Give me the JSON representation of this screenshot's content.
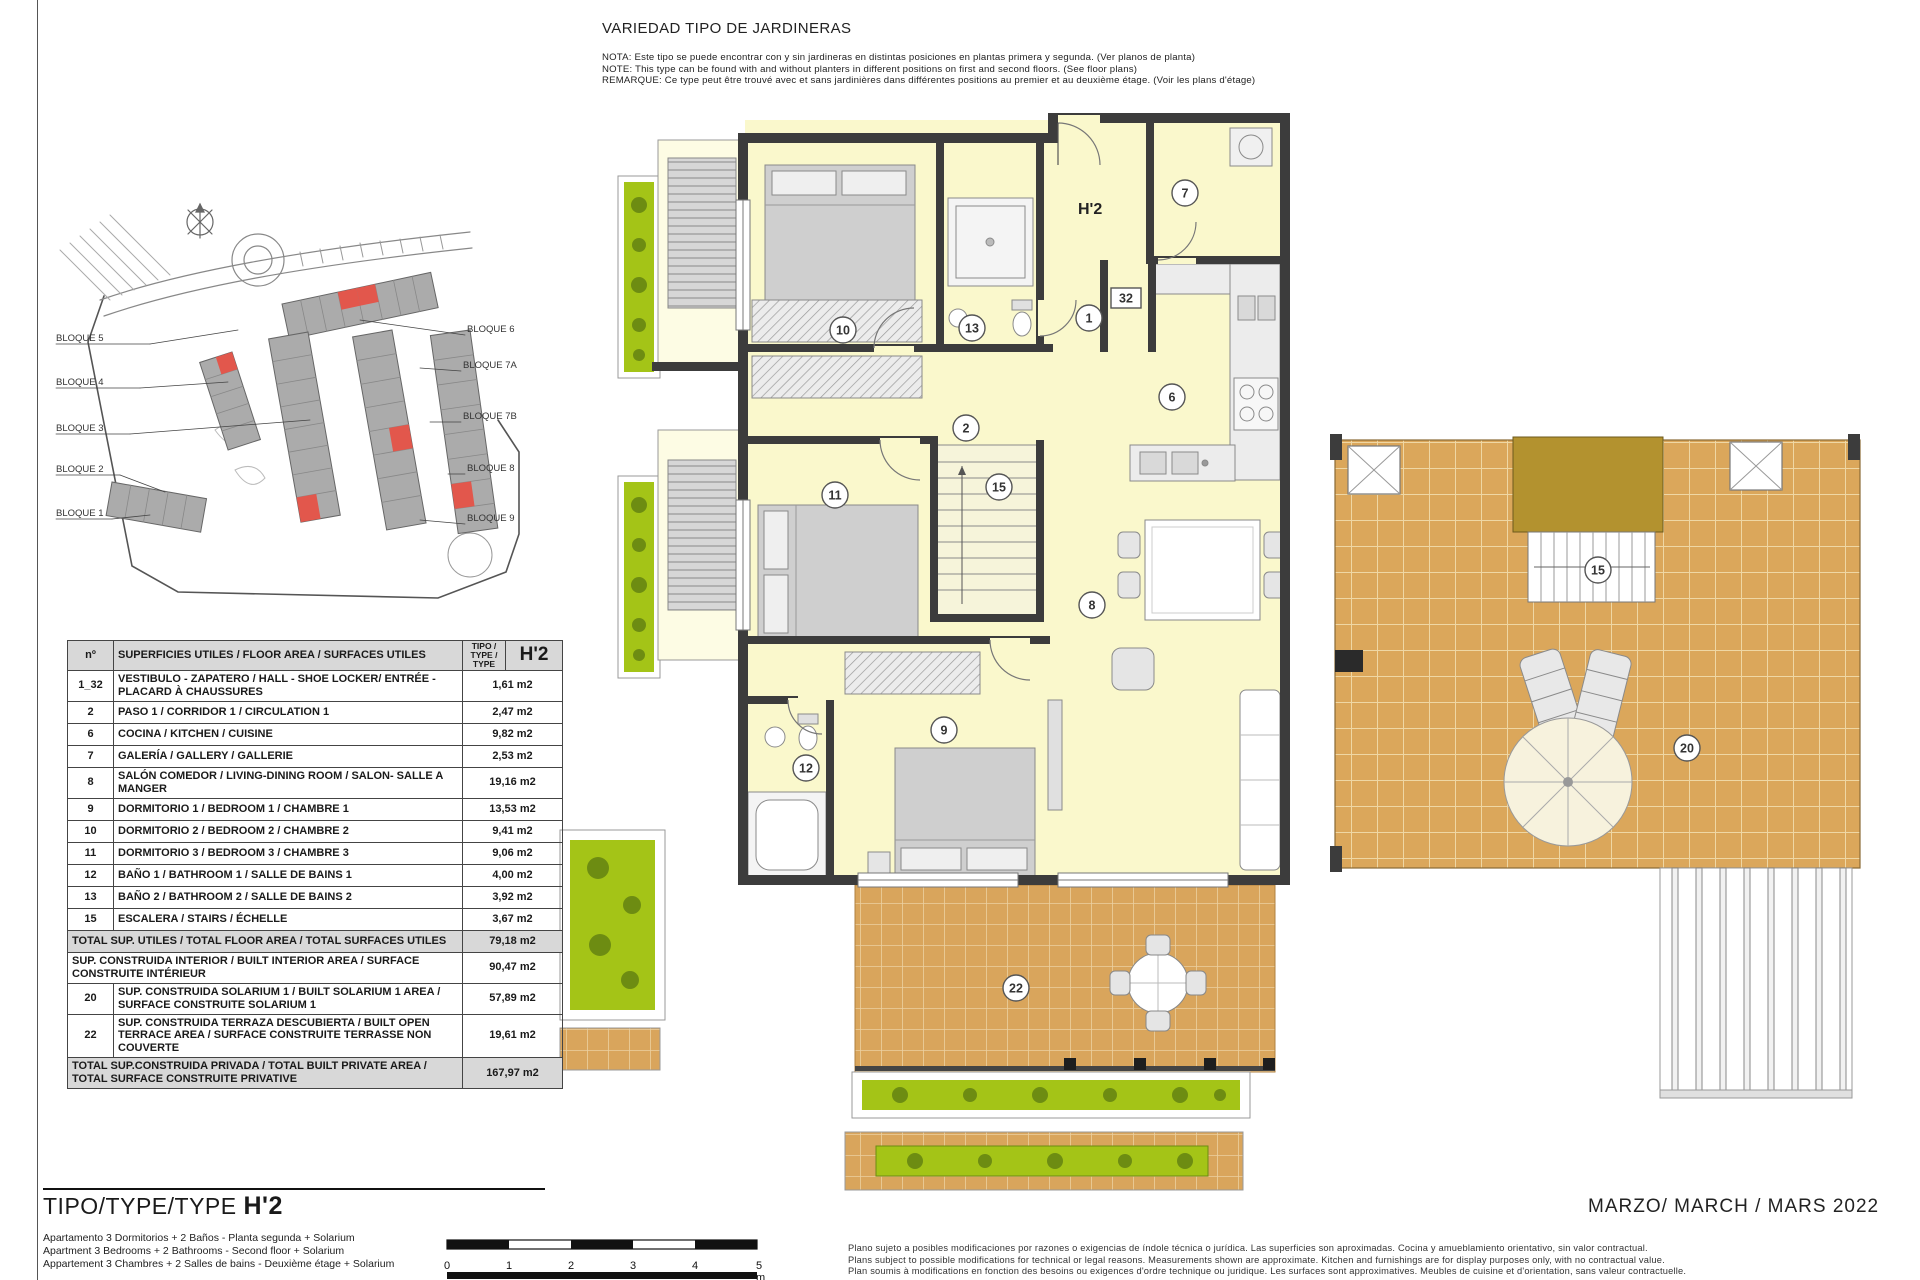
{
  "header": {
    "title": "VARIEDAD TIPO DE JARDINERAS",
    "notes": [
      "NOTA: Este tipo se puede encontrar con y sin jardineras en distintas posiciones en plantas primera y segunda. (Ver planos de planta)",
      "NOTE: This type can be found with and without planters in different positions on first and second floors. (See floor plans)",
      "REMARQUE: Ce type peut être trouvé avec et sans jardinières dans différentes positions au premier et au deuxième étage. (Voir les plans d'étage)"
    ]
  },
  "site_plan": {
    "blocks_left": [
      "BLOQUE 5",
      "BLOQUE 4",
      "BLOQUE 3",
      "BLOQUE 2",
      "BLOQUE 1"
    ],
    "blocks_right": [
      "BLOQUE 6",
      "BLOQUE 7A",
      "BLOQUE 7B",
      "BLOQUE 8",
      "BLOQUE 9"
    ]
  },
  "area_table": {
    "header": {
      "no": "nº",
      "desc": "SUPERFICIES UTILES / FLOOR AREA / SURFACES UTILES",
      "tipo": "TIPO / TYPE / TYPE",
      "type_code": "H'2"
    },
    "rows": [
      {
        "no": "1_32",
        "desc": "VESTIBULO - ZAPATERO / HALL - SHOE LOCKER/ ENTRÉE - PLACARD À CHAUSSURES",
        "value": "1,61 m2"
      },
      {
        "no": "2",
        "desc": "PASO 1 / CORRIDOR 1 / CIRCULATION 1",
        "value": "2,47 m2"
      },
      {
        "no": "6",
        "desc": "COCINA / KITCHEN / CUISINE",
        "value": "9,82 m2"
      },
      {
        "no": "7",
        "desc": "GALERÍA / GALLERY / GALLERIE",
        "value": "2,53 m2"
      },
      {
        "no": "8",
        "desc": "SALÓN COMEDOR  / LIVING-DINING ROOM / SALON- SALLE A MANGER",
        "value": "19,16 m2"
      },
      {
        "no": "9",
        "desc": "DORMITORIO 1 / BEDROOM 1 / CHAMBRE 1",
        "value": "13,53 m2"
      },
      {
        "no": "10",
        "desc": "DORMITORIO 2 / BEDROOM 2 / CHAMBRE 2",
        "value": "9,41 m2"
      },
      {
        "no": "11",
        "desc": "DORMITORIO 3 / BEDROOM 3 / CHAMBRE 3",
        "value": "9,06 m2"
      },
      {
        "no": "12",
        "desc": "BAÑO 1 / BATHROOM 1 / SALLE DE BAINS 1",
        "value": "4,00 m2"
      },
      {
        "no": "13",
        "desc": "BAÑO 2 / BATHROOM 2 / SALLE DE BAINS 2",
        "value": "3,92 m2"
      },
      {
        "no": "15",
        "desc": "ESCALERA / STAIRS / ÉCHELLE",
        "value": "3,67 m2"
      },
      {
        "no": "",
        "desc": "TOTAL SUP. UTILES / TOTAL FLOOR AREA / TOTAL SURFACES UTILES",
        "value": "79,18 m2"
      },
      {
        "no": "",
        "desc": "SUP. CONSTRUIDA INTERIOR / BUILT INTERIOR AREA / SURFACE CONSTRUITE INTÉRIEUR",
        "value": "90,47 m2"
      },
      {
        "no": "20",
        "desc": "SUP. CONSTRUIDA SOLARIUM 1 / BUILT SOLARIUM 1 AREA / SURFACE CONSTRUITE SOLARIUM 1",
        "value": "57,89 m2"
      },
      {
        "no": "22",
        "desc": "SUP. CONSTRUIDA TERRAZA DESCUBIERTA / BUILT OPEN TERRACE AREA /  SURFACE CONSTRUITE TERRASSE NON COUVERTE",
        "value": "19,61 m2"
      },
      {
        "no": "",
        "desc": "TOTAL SUP.CONSTRUIDA PRIVADA / TOTAL  BUILT PRIVATE AREA / TOTAL SURFACE CONSTRUITE PRIVATIVE",
        "value": "167,97 m2"
      }
    ]
  },
  "floor_plan": {
    "unit_label": "H'2",
    "rooms": [
      {
        "n": "10"
      },
      {
        "n": "13"
      },
      {
        "n": "1"
      },
      {
        "n": "32"
      },
      {
        "n": "7"
      },
      {
        "n": "6"
      },
      {
        "n": "2"
      },
      {
        "n": "15"
      },
      {
        "n": "11"
      },
      {
        "n": "8"
      },
      {
        "n": "9"
      },
      {
        "n": "12"
      },
      {
        "n": "22"
      }
    ]
  },
  "solarium": {
    "labels": [
      {
        "n": "15"
      },
      {
        "n": "20"
      }
    ]
  },
  "footer": {
    "type_label": "TIPO/TYPE/TYPE",
    "type_code": "H'2",
    "descriptions": [
      "Apartamento 3 Dormitorios + 2 Baños - Planta segunda + Solarium",
      "Apartment 3 Bedrooms + 2 Bathrooms - Second floor + Solarium",
      "Appartement 3 Chambres + 2 Salles de bains - Deuxième étage + Solarium"
    ],
    "scale_ticks": [
      "0",
      "1",
      "2",
      "3",
      "4",
      "5 m"
    ],
    "disclaimer": [
      "Plano sujeto a posibles modificaciones por razones o exigencias de índole técnica o jurídica. Las superficies son aproximadas. Cocina y amueblamiento orientativo, sin valor contractual.",
      "Plans subject to possible modifications for technical or legal reasons. Measurements shown are approximate. Kitchen and furnishings are for display purposes only, with no contractual value.",
      "Plan soumis à modifications en fonction des besoins ou exigences d'ordre technique ou juridique. Les surfaces sont approximatives. Meubles de cuisine et d'orientation, sans valeur contractuelle."
    ],
    "date": "MARZO/ MARCH / MARS  2022"
  },
  "colors": {
    "wall": "#3c3c3c",
    "room_fill": "#faf8cc",
    "terrace_tile": "#d9a55c",
    "solarium_tile": "#dba75b",
    "stair_block": "#b3922f",
    "planter_green": "#a4c417",
    "highlight_red": "#e2574c",
    "building_gray": "#ababab",
    "table_gray": "#d8d8d8"
  }
}
